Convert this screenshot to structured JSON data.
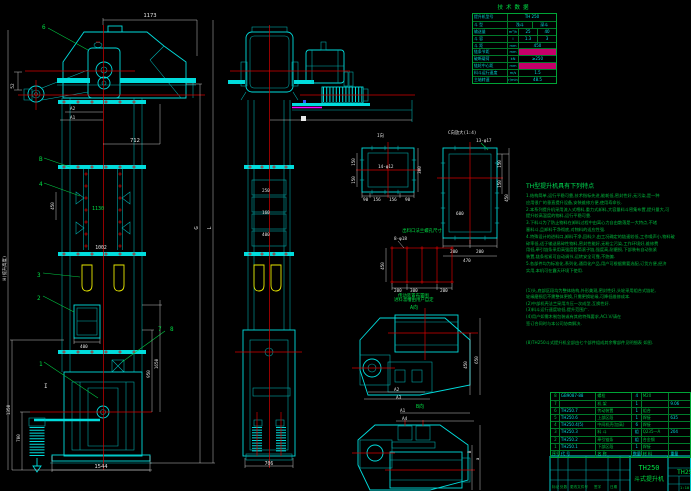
{
  "tech_table": {
    "title": "技术数据",
    "rows": [
      {
        "label": "提升机型号",
        "unit": "",
        "value": "TH 250"
      },
      {
        "label": "斗 型",
        "unit": "",
        "v1": "浅斗",
        "v2": "深斗"
      },
      {
        "label": "输送量",
        "unit": "m³/h",
        "v1": "25",
        "v2": "40"
      },
      {
        "label": "斗 容",
        "unit": "l",
        "v1": "1.3",
        "v2": "3"
      },
      {
        "label": "斗 距",
        "unit": "mm",
        "value": "450"
      },
      {
        "label": "链条节距",
        "unit": "mm",
        "value": ""
      },
      {
        "label": "破断载荷",
        "unit": "kN",
        "value": "≥250"
      },
      {
        "label": "链轮中心距",
        "unit": "mm",
        "value": ""
      },
      {
        "label": "料斗运行速度",
        "unit": "m/s",
        "value": "1.5"
      },
      {
        "label": "主轴转速",
        "unit": "r/min",
        "value": "48.5"
      }
    ]
  },
  "features": {
    "title": "TH型提升机具有下列特点",
    "body": "1.结构简单,运行平稳可靠,技术指标先进,能耗低,密封性好,无污染,是一种\n应用很广的垂直提升设备,安装维修方便,使用寿命长.\n2.本系列提升机采用流入式喂料,重力式卸料,大容量料斗密集布置,提升量大,可\n提升较高温度的物料,运行平稳可靠.\n3.下料斗为了防止物料在卸料过程中由离心力自由散落是一大特点,不堵\n塞料斗,且卸料干净彻底,对物料的适应性强.\n4.特殊设计的进料口,卸料干净,回料少,由工况确定的链速较低,工作噪声小,物料破\n碎率低,适于输送易碎性物料,密封性能好,无粉尘污染,工作环境好,维修费\n用低,牵引链条采用高强度套筒滚子链,强度高,耐磨损,下部装有自动张紧\n装置,链条松紧可自动调节,运转安全可靠,不跑偏.\n5.各部件均为标准化,系列化,通用化产品,用户可根据需要选配,订货方便,经济\n实用,本机可在露天环境下使用.",
    "notes": "(1)头,底部区段均为整体结构,外形美观,密封性好,头轮采用组合式链轮,\n轮缘磨损后不需整体更换,只需更换轮缘,可降低维修成本.\n(2)中部机壳法兰采用冷压一次成型,互换性好.\n(3)料斗运行速度较低,提升范围广.\n(4)用户如需木制包装或有其他特殊要求,ACI.V/请在\n签订合同时与本公司协商解决.",
    "footnote": "(8)TH250斗式提升机全部由七个部件组成其余零部件见明细表 如图."
  },
  "bom": {
    "header": {
      "no": "序号",
      "code": "代 号",
      "name": "名 称",
      "qty": "数量",
      "material": "材 料",
      "weight": "重量"
    },
    "rows": [
      {
        "no": "8",
        "code": "GB9087-88",
        "name": "螺栓",
        "qty": "4",
        "material": "M20",
        "weight": ""
      },
      {
        "no": "7",
        "code": "",
        "name": "机 架",
        "qty": "1",
        "material": "",
        "weight": "9.06"
      },
      {
        "no": "6",
        "code": "TH250.7",
        "name": "传动装置",
        "qty": "1",
        "material": "组合",
        "weight": ""
      },
      {
        "no": "5",
        "code": "TH250.6",
        "name": "上部区段",
        "qty": "1",
        "material": "焊接",
        "weight": "635"
      },
      {
        "no": "4",
        "code": "TH250.4(5)",
        "name": "中间机壳(加高)",
        "qty": "6",
        "material": "焊接",
        "weight": ""
      },
      {
        "no": "3",
        "code": "TH250.3",
        "name": "料 斗",
        "qty": "组",
        "material": "Q235—A",
        "weight": "204"
      },
      {
        "no": "2",
        "code": "TH250.2",
        "name": "牵引链条",
        "qty": "组",
        "material": "合金钢",
        "weight": ""
      },
      {
        "no": "1",
        "code": "TH250.1",
        "name": "下部区段",
        "qty": "1",
        "material": "焊接",
        "weight": ""
      }
    ]
  },
  "title_block": {
    "model": "TH250",
    "product": "斗式提升机",
    "drawing_no": "TH250",
    "rev": {
      "mark": "标记",
      "count": "处数",
      "doc": "更改文件号",
      "sign": "签字",
      "date": "日期"
    },
    "scale": "1:10"
  },
  "labels": {
    "balloons": {
      "n1": "1",
      "n2": "2",
      "n3": "3",
      "n4": "4",
      "n6": "6",
      "n7": "7",
      "n8": "8",
      "nB": "B"
    },
    "views": {
      "i": "I向",
      "c": "C向放大(1:4)",
      "a": "A向",
      "b": "B向",
      "layout": "传动装置布置图"
    },
    "flange": {
      "holes14": "14-φ12",
      "holes13": "13-φ17",
      "holes8": "8-φ18",
      "grid_title": "出料口法兰螺孔尺寸",
      "grid_note": "进料溜槽由用户自定"
    },
    "section_i": "I"
  },
  "dims": {
    "top_width": "1173",
    "head_offset": "712",
    "mid_pitch": "450",
    "casing_width": "1130",
    "casing_inner": "1002",
    "door": "400",
    "base_width": "1544",
    "boot_left": "1350",
    "boot_takeup": "700",
    "pulley": "52",
    "a1": "A1",
    "a2": "A2",
    "a3": "A3",
    "a4": "A4",
    "len_l": "L",
    "len_g": "G",
    "boot_h1": "950",
    "boot_h2": "1650",
    "height_label": "H(提升高度)",
    "link1": "250",
    "link2": "160",
    "link3": "400",
    "boot_side_width": "706",
    "fi_left1": "150",
    "fi_left2": "150",
    "fi_right": "300",
    "fi_b1": "90",
    "fi_b2": "156",
    "fi_b3": "156",
    "fi_b4": "90",
    "fc_r1": "150",
    "fc_r2": "150",
    "fc_r3": "450",
    "fc_b1": "200",
    "fc_b2": "200",
    "fc_b3": "470",
    "fc_inner": "600",
    "g_left": "450",
    "g_b1": "200",
    "g_b2": "300",
    "g_b3": "200",
    "dv1_r1": "450",
    "dv1_r2": "650",
    "dv2_b": "B",
    "dv2_a": "a"
  }
}
